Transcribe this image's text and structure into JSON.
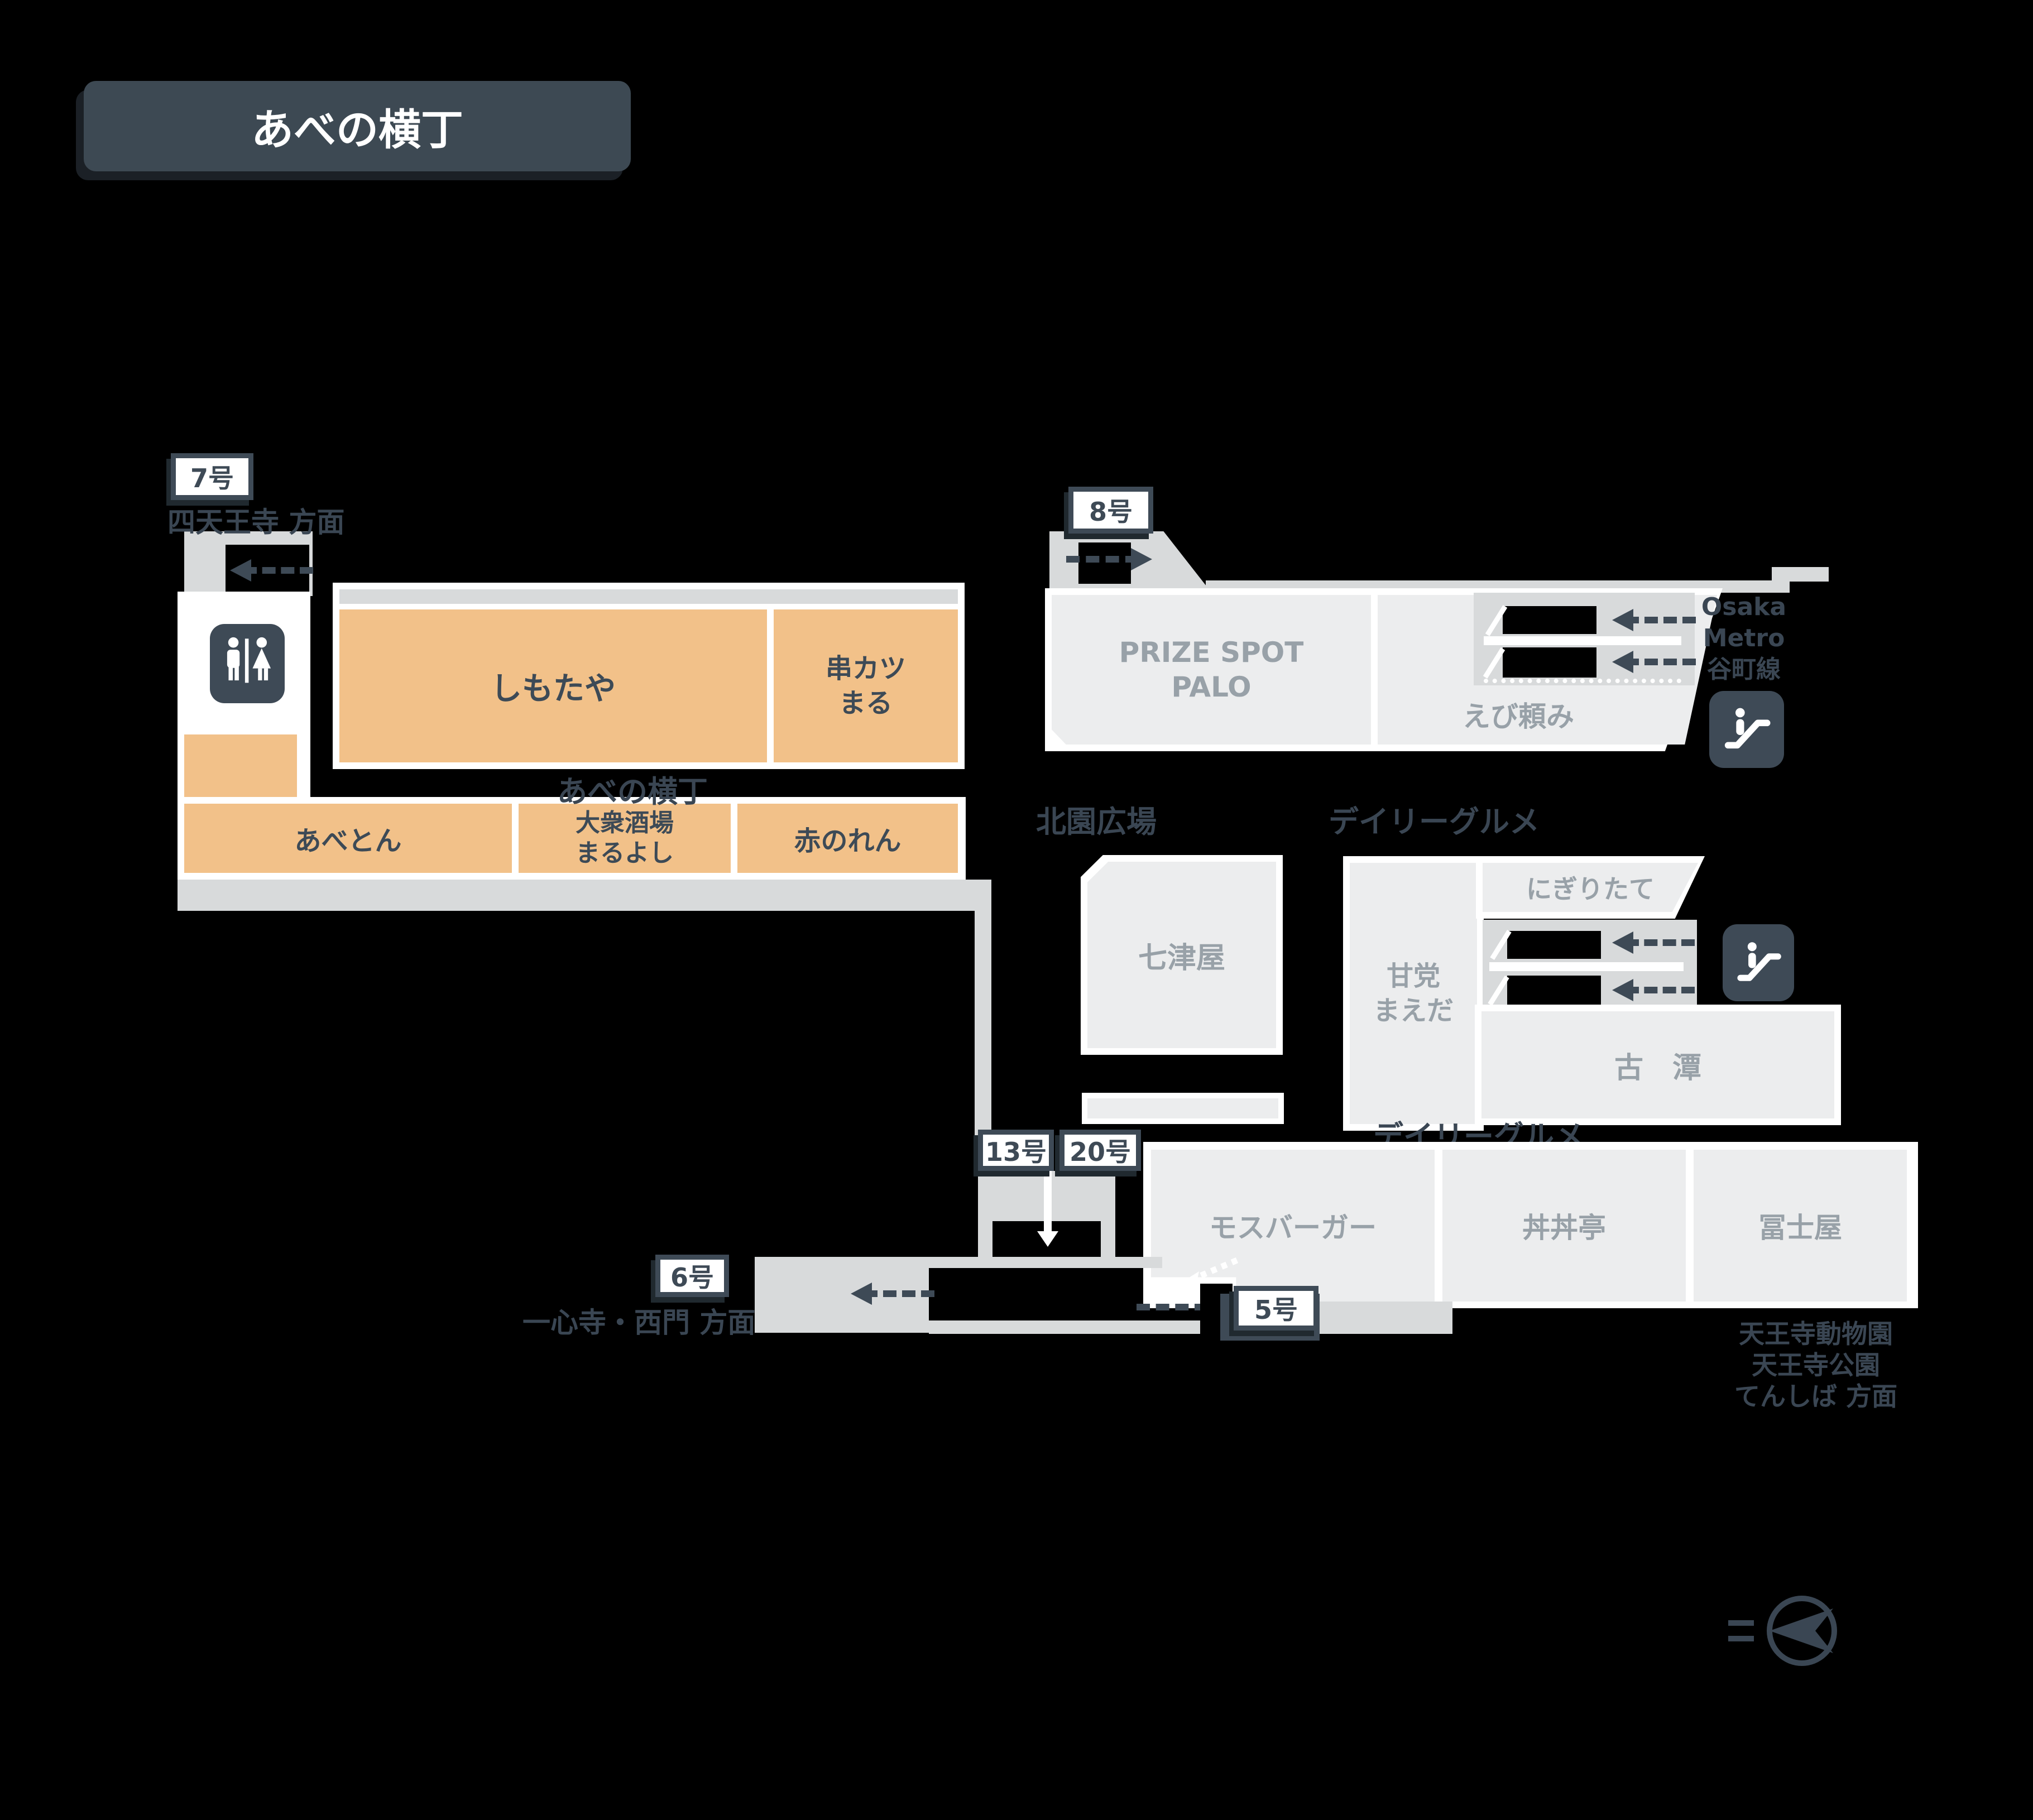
{
  "title": "あべの横丁",
  "exits": {
    "e5": "5号",
    "e6": "6号",
    "e7": "7号",
    "e8": "8号",
    "e13": "13号",
    "e20": "20号"
  },
  "directions": {
    "shitennoji": "四天王寺 方面",
    "isshinji": "一心寺・西門 方面",
    "metro": "Osaka\nMetro\n谷町線",
    "tennoji": "天王寺動物園\n天王寺公園\nてんしば 方面"
  },
  "areas": {
    "yokocho_path": "あべの横丁",
    "kitazono_hiroba": "北園広場",
    "daily_gourmet": "デイリーグルメ"
  },
  "shops": {
    "shimotaya": "しもたや",
    "kushikatsu_maru": "串カツ\nまる",
    "abeton": "あべとん",
    "maruyoshi": "大衆酒場\nまるよし",
    "akanoren": "赤のれん",
    "prize_spot_palo": "PRIZE SPOT\nPALO",
    "ebidanomi": "えび頼み",
    "nanatsuya": "七津屋",
    "amato_maeda": "甘党\nまえだ",
    "nigiritate": "にぎりたて",
    "kotan": "古　潭",
    "mos_burger": "モスバーガー",
    "dondontei": "丼丼亭",
    "fujiya": "冨士屋"
  },
  "icons": {
    "restroom": "restroom-icon",
    "escalator": "escalator-icon",
    "compass": "compass-icon"
  },
  "colors": {
    "accent_orange": "#f2c189",
    "block_gray": "#ecedee",
    "walkway_gray": "#d8dadb",
    "dark_slate": "#3e4a56",
    "muted_text": "#98a1a8",
    "white": "#ffffff",
    "background": "#000000"
  }
}
